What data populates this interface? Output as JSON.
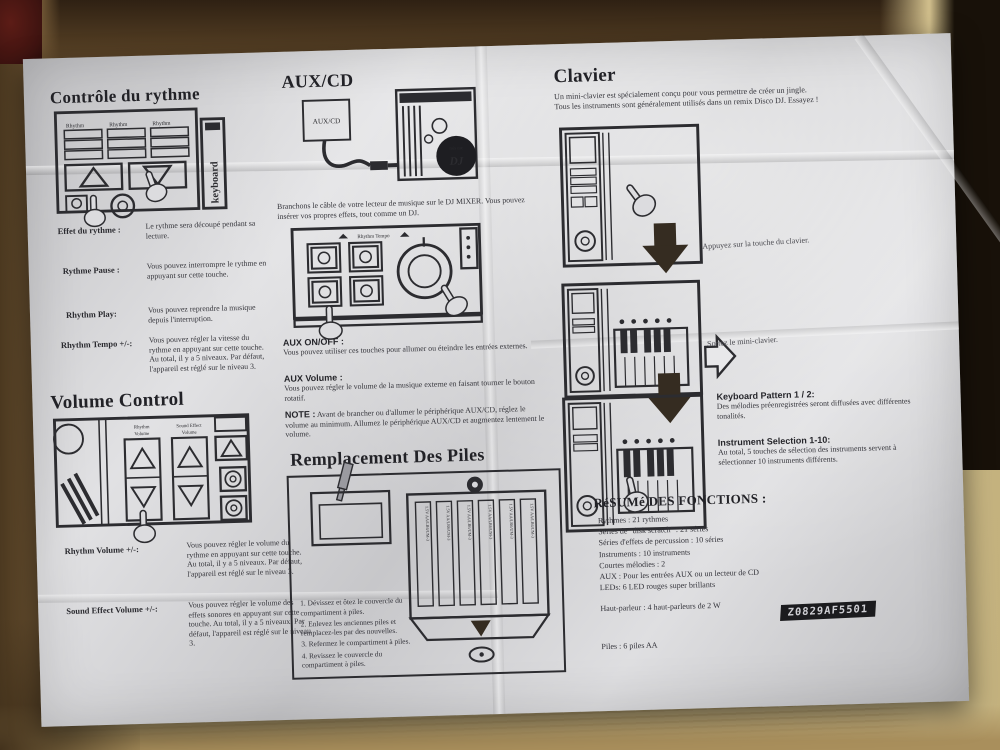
{
  "colors": {
    "paper": "#d6d6d9",
    "wood_light": "#cebc8a",
    "wood_dark": "#2f2113",
    "label_bg": "#1b1b1e"
  },
  "rhythm_section": {
    "title": "Contrôle du rythme",
    "diagram": {
      "keyboard_label": "keyboard",
      "button_label": "Rhythm"
    },
    "defs": [
      {
        "term": "Effet du rythme :",
        "desc": "Le rythme sera découpé pendant sa lecture."
      },
      {
        "term": "Rythme Pause :",
        "desc": "Vous pouvez interrompre le rythme en appuyant sur cette touche."
      },
      {
        "term": "Rhythm Play:",
        "desc": "Vous pouvez reprendre la musique depuis l'interruption."
      },
      {
        "term": "Rhythm Tempo +/-:",
        "desc": "Vous pouvez régler la vitesse du rythme en appuyant sur cette touche. Au total, il y a 5 niveaux. Par défaut, l'appareil est réglé sur le niveau 3."
      }
    ]
  },
  "volume_section": {
    "title": "Volume Control",
    "diagram": {
      "col1_l1": "Rhythm",
      "col1_l2": "Volume",
      "col2_l1": "Sound Effect",
      "col2_l2": "Volume"
    },
    "defs": [
      {
        "term": "Rhythm Volume +/-:",
        "desc": "Vous pouvez régler le volume du rythme en appuyant sur cette touche. Au total, il y a 5 niveaux. Par défaut, l'appareil est réglé sur le niveau 3."
      },
      {
        "term": "Sound Effect Volume +/-:",
        "desc": "Vous pouvez régler le volume des effets sonores en appuyant sur cette touche. Au total, il y a 5 niveaux. Par défaut, l'appareil est réglé sur le niveau 3."
      }
    ]
  },
  "aux_section": {
    "title": "AUX/CD",
    "jack_label": "AUX/CD",
    "mixer_brand_top": "mix me",
    "mixer_brand_main": "DJ",
    "panel_label": "Rhythm Tempo",
    "intro": "Branchons le câble de votre lecteur de musique sur le DJ MIXER. Vous pouvez insérer vos propres effets, tout comme un DJ.",
    "on_off_title": "AUX ON/OFF :",
    "on_off_text": "Vous pouvez utiliser ces touches pour allumer ou éteindre les entrées externes.",
    "volume_title": "AUX Volume :",
    "volume_text": "Vous pouvez régler le volume de la musique externe en faisant tourner le bouton rotatif.",
    "note_label": "NOTE :",
    "note_text": "Avant de brancher ou d'allumer le périphérique AUX/CD, réglez le volume au minimum. Allumez le périphérique AUX/CD et augmentez lentement le volume."
  },
  "battery_section": {
    "title": "Remplacement Des Piles",
    "battery_label": "1.5V AA/LR6/UM-3",
    "steps": [
      "1. Dévissez et ôtez le couvercle du compartiment à piles.",
      "2. Enlevez les anciennes piles et remplacez-les par des nouvelles.",
      "3. Refermez le compartiment à piles.",
      "4. Revissez le couvercle du compartiment à piles."
    ]
  },
  "keyboard_section": {
    "title": "Clavier",
    "intro_line1": "Un mini-clavier est spécialement conçu pour vous permettre de créer un jingle.",
    "intro_line2": "Tous les instruments sont généralement utilisés dans un remix Disco DJ. Essayez !",
    "caption1": "Appuyez sur la touche du clavier.",
    "caption2": "Sortez le mini-clavier.",
    "pattern_title": "Keyboard Pattern 1 / 2:",
    "pattern_text": "Des mélodies préenregistrées seront diffusées avec différentes tonalités.",
    "instrument_title": "Instrument Selection 1-10:",
    "instrument_text": "Au total, 5 touches de sélection des instruments servent à sélectionner 10 instruments différents."
  },
  "summary_section": {
    "title": "RéSUMé DES FONCTIONS :",
    "lines": [
      "Rythmes : 21 rythmes",
      "Séries de \"disk scratch\" : 21 séries",
      "Séries d'effets de percussion : 10 séries",
      "Instruments : 10 instruments",
      "Courtes mélodies : 2",
      "AUX : Pour les entrées AUX ou un lecteur de CD",
      "LEDs: 6 LED rouges super brillants"
    ],
    "speaker_line": "Haut-parleur : 4 haut-parleurs de 2 W",
    "battery_line": "Piles : 6 piles AA",
    "code": "Z0829AF5501"
  }
}
